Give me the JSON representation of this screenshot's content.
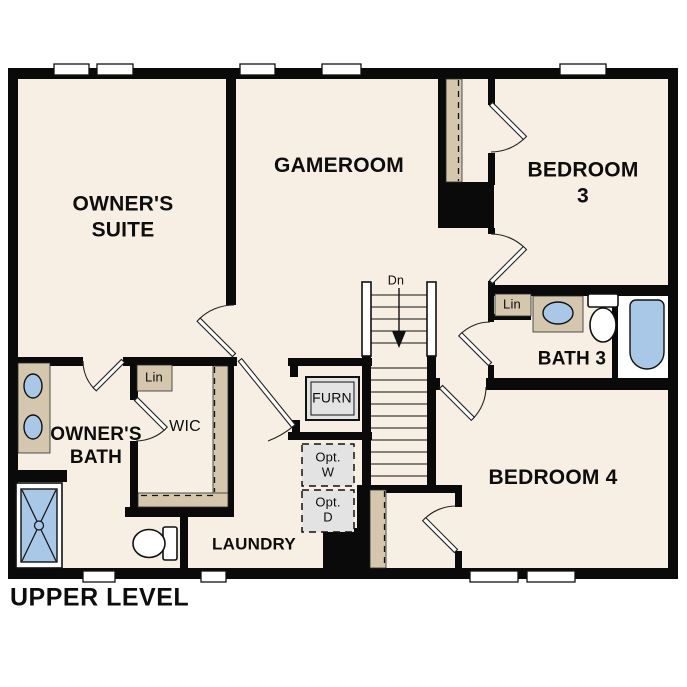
{
  "plan": {
    "title": "UPPER LEVEL"
  },
  "rooms": {
    "owners_suite": "OWNER'S\nSUITE",
    "gameroom": "GAMEROOM",
    "bedroom3": "BEDROOM 3",
    "bath3": "BATH 3",
    "bedroom4": "BEDROOM 4",
    "owners_bath": "OWNER'S\nBATH",
    "wic": "WIC",
    "laundry": "LAUNDRY"
  },
  "closets": {
    "lin_wic": "Lin",
    "lin_bath3": "Lin"
  },
  "equipment": {
    "furnace": "FURN",
    "opt_washer": "Opt.\nW",
    "opt_dryer": "Opt.\nD"
  },
  "stairs": {
    "down_label": "Dn"
  },
  "colors": {
    "background": "#ffffff",
    "floor": "#f7efe3",
    "wall": "#0a0a0a",
    "cabinet_tan": "#d4c7ad",
    "fixture_blue": "#a9c7e6",
    "appliance_gray": "#e3e3e3"
  }
}
